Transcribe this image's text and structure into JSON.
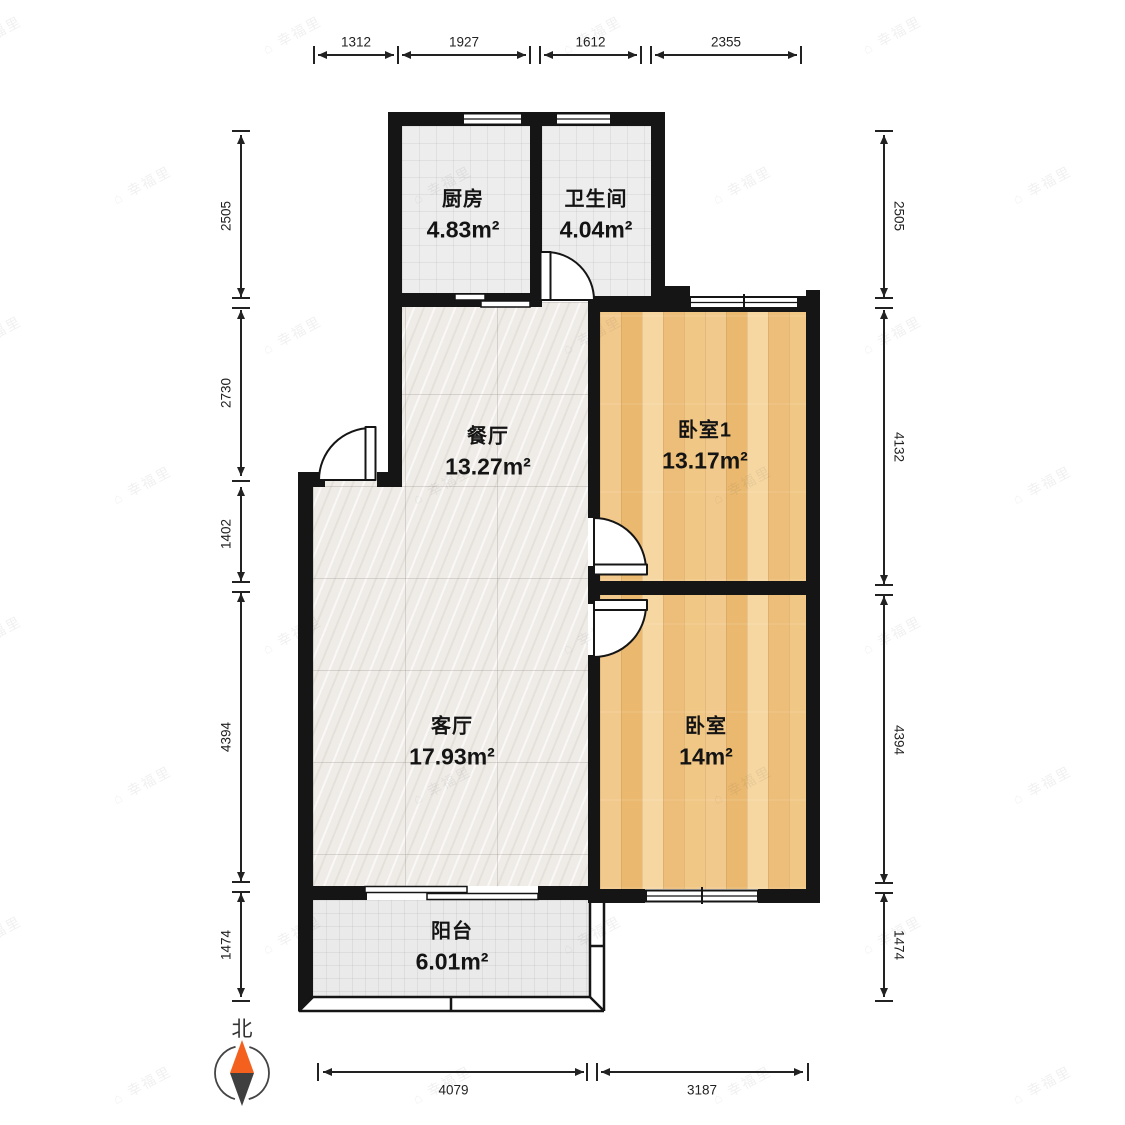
{
  "rooms": [
    {
      "id": "kitchen",
      "name": "厨房",
      "area": "4.83m²"
    },
    {
      "id": "bathroom",
      "name": "卫生间",
      "area": "4.04m²"
    },
    {
      "id": "dining",
      "name": "餐厅",
      "area": "13.27m²"
    },
    {
      "id": "bedroom1",
      "name": "卧室1",
      "area": "13.17m²"
    },
    {
      "id": "living",
      "name": "客厅",
      "area": "17.93m²"
    },
    {
      "id": "bedroom",
      "name": "卧室",
      "area": "14m²"
    },
    {
      "id": "balcony",
      "name": "阳台",
      "area": "6.01m²"
    }
  ],
  "compass": {
    "label": "北"
  },
  "watermark": {
    "text": "幸福里"
  },
  "colors": {
    "wall": "#151515",
    "wood_floor": "#f0c489",
    "tile_floor": "#ededed",
    "marble_floor": "#efece8",
    "compass_orange": "#f4611e",
    "compass_dark": "#3f3f3f",
    "dimension_text": "#222222"
  },
  "dimensions": {
    "top": {
      "axis": "h",
      "line_y": 55,
      "label_y": 42,
      "items": [
        {
          "label": "1312",
          "a": 318,
          "b": 394
        },
        {
          "label": "1927",
          "a": 402,
          "b": 526
        },
        {
          "label": "1612",
          "a": 544,
          "b": 637
        },
        {
          "label": "2355",
          "a": 655,
          "b": 797
        }
      ],
      "ticks": [
        {
          "p": 314,
          "t": 1
        },
        {
          "p": 398,
          "t": 1
        },
        {
          "p": 535,
          "t": 2
        },
        {
          "p": 646,
          "t": 2
        },
        {
          "p": 801,
          "t": 1
        }
      ]
    },
    "left": {
      "axis": "v",
      "line_x": 241,
      "label_x": 226,
      "rotate": -90,
      "items": [
        {
          "label": "2505",
          "a": 135,
          "b": 297
        },
        {
          "label": "2730",
          "a": 310,
          "b": 476
        },
        {
          "label": "1402",
          "a": 487,
          "b": 581
        },
        {
          "label": "4394",
          "a": 593,
          "b": 881
        },
        {
          "label": "1474",
          "a": 893,
          "b": 997
        }
      ],
      "ticks": [
        {
          "p": 131,
          "t": 1
        },
        {
          "p": 303,
          "t": 2
        },
        {
          "p": 481,
          "t": 1
        },
        {
          "p": 587,
          "t": 2
        },
        {
          "p": 887,
          "t": 2
        },
        {
          "p": 1001,
          "t": 1
        }
      ]
    },
    "right": {
      "axis": "v",
      "line_x": 884,
      "label_x": 899,
      "rotate": 90,
      "items": [
        {
          "label": "2505",
          "a": 135,
          "b": 297
        },
        {
          "label": "4132",
          "a": 310,
          "b": 584
        },
        {
          "label": "4394",
          "a": 596,
          "b": 883
        },
        {
          "label": "1474",
          "a": 893,
          "b": 997
        }
      ],
      "ticks": [
        {
          "p": 131,
          "t": 1
        },
        {
          "p": 303,
          "t": 2
        },
        {
          "p": 590,
          "t": 2
        },
        {
          "p": 888,
          "t": 2
        },
        {
          "p": 1001,
          "t": 1
        }
      ]
    },
    "bottom": {
      "axis": "h",
      "line_y": 1072,
      "label_y": 1090,
      "items": [
        {
          "label": "4079",
          "a": 323,
          "b": 584
        },
        {
          "label": "3187",
          "a": 601,
          "b": 803
        }
      ],
      "ticks": [
        {
          "p": 318,
          "t": 1
        },
        {
          "p": 592,
          "t": 2
        },
        {
          "p": 808,
          "t": 1
        }
      ]
    }
  }
}
